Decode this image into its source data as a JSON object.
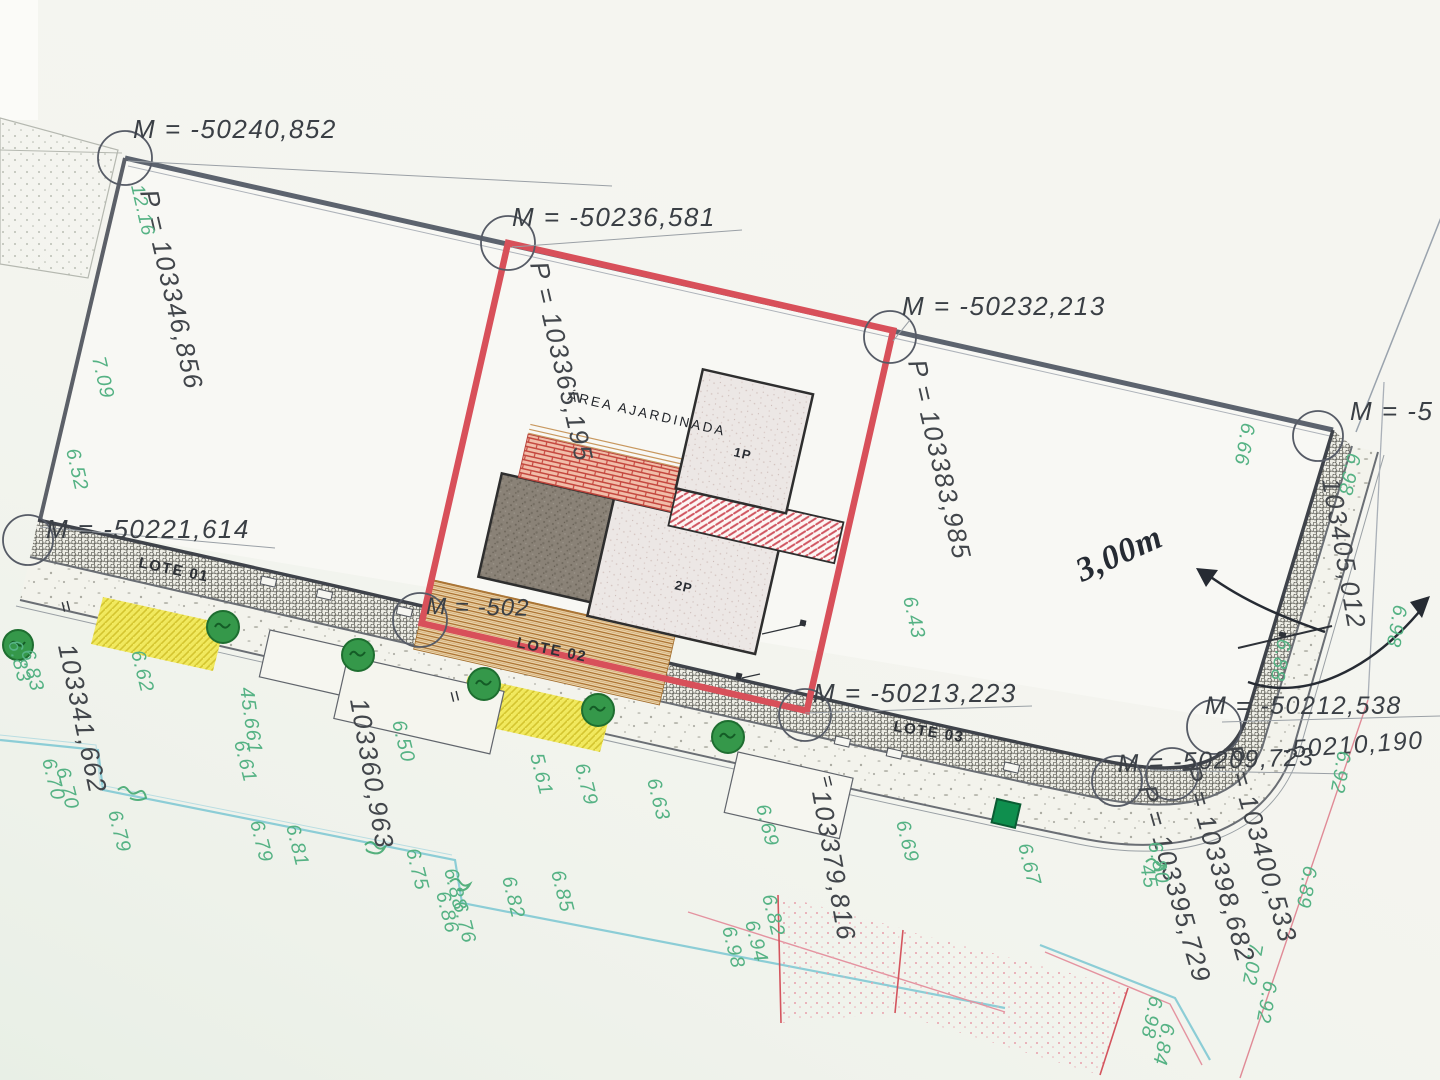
{
  "document": {
    "type": "survey site plan (planta de implantação)",
    "accent_red": "#d8505a",
    "green_note_color": "#55b284",
    "paper_color": "#f5f5f0"
  },
  "labels": {
    "m_points": [
      {
        "n": "m-coord-50240",
        "t": "M  =  -50240,852",
        "x": 133,
        "y": 138,
        "r": 0
      },
      {
        "n": "m-coord-50236",
        "t": "M  =  -50236,581",
        "x": 512,
        "y": 226,
        "r": 0
      },
      {
        "n": "m-coord-50232",
        "t": "M  =  -50232,213",
        "x": 902,
        "y": 315,
        "r": 0
      },
      {
        "n": "m-coord-edge-cut",
        "t": "M  =  -5",
        "x": 1350,
        "y": 420,
        "r": 0
      },
      {
        "n": "m-coord-50221",
        "t": "M  =  -50221,614",
        "x": 46,
        "y": 538,
        "r": 0
      },
      {
        "n": "m-coord-50213",
        "t": "M  =  -50213,223",
        "x": 813,
        "y": 702,
        "r": 0
      },
      {
        "n": "m-coord-50212",
        "t": "M  =  -50212,538",
        "x": 1205,
        "y": 714,
        "r": 0,
        "s": 25
      },
      {
        "n": "m-coord-50210",
        "t": "-50210,190",
        "x": 1283,
        "y": 758,
        "r": -4,
        "s": 25
      },
      {
        "n": "m-coord-50209",
        "t": "M  =  -50209,723",
        "x": 1118,
        "y": 772,
        "r": -2,
        "s": 25
      }
    ],
    "m_fragment": {
      "n": "m-coord-lote02-hidden",
      "t": "M  =  -502",
      "x": 426,
      "y": 614,
      "r": 1
    },
    "p_points": [
      {
        "n": "p-coord-103346",
        "t": "P  =  103346,856",
        "x": 140,
        "y": 192,
        "r": 77
      },
      {
        "n": "p-coord-103365",
        "t": "P  =  103365,195",
        "x": 530,
        "y": 264,
        "r": 77
      },
      {
        "n": "p-coord-103383",
        "t": "P  =  103383,985",
        "x": 908,
        "y": 362,
        "r": 77
      },
      {
        "n": "p-coord-103405",
        "t": "103405,012",
        "x": 1322,
        "y": 480,
        "r": 80
      },
      {
        "n": "p-coord-103400",
        "t": "P  =  103400,533",
        "x": 1224,
        "y": 748,
        "r": 74
      },
      {
        "n": "p-coord-103398",
        "t": "P  =  103398,682",
        "x": 1182,
        "y": 768,
        "r": 74
      },
      {
        "n": "p-coord-103395",
        "t": "P  =  103395,729",
        "x": 1138,
        "y": 788,
        "r": 74
      },
      {
        "n": "p-coord-103379",
        "t": "103379,816",
        "x": 812,
        "y": 792,
        "r": 80
      },
      {
        "n": "p-coord-103360",
        "t": "103360,963",
        "x": 350,
        "y": 700,
        "r": 80
      },
      {
        "n": "p-coord-103341",
        "t": "103341,662",
        "x": 58,
        "y": 646,
        "r": 78
      }
    ],
    "lotes": [
      {
        "n": "lote-01-label",
        "t": "LOTE 01",
        "x": 138,
        "y": 567,
        "r": 12
      },
      {
        "n": "lote-02-label",
        "t": "LOTE 02",
        "x": 516,
        "y": 647,
        "r": 12
      },
      {
        "n": "lote-03-label",
        "t": "LOTE 03",
        "x": 893,
        "y": 731,
        "r": 9
      }
    ],
    "area": {
      "text": "ÁREA AJARDINADA"
    },
    "buildings": [
      {
        "n": "building-1p-label",
        "t": "1P",
        "x": 733,
        "y": 456,
        "r": 13
      },
      {
        "n": "building-2p-label",
        "t": "2P",
        "x": 674,
        "y": 589,
        "r": 13
      }
    ],
    "handwritten": {
      "text": "3,00m"
    },
    "marks": [
      {
        "n": "level-mark",
        "t": "=",
        "x": 58,
        "y": 602,
        "r": 76
      },
      {
        "n": "level-mark",
        "t": "=",
        "x": 447,
        "y": 692,
        "r": 76
      },
      {
        "n": "level-mark",
        "t": "=",
        "x": 820,
        "y": 777,
        "r": 76
      }
    ]
  },
  "green_dims": [
    {
      "t": "12.16",
      "x": 131,
      "y": 186,
      "r": 77,
      "s": 19
    },
    {
      "t": "7.09",
      "x": 92,
      "y": 358,
      "r": 77
    },
    {
      "t": "6.52",
      "x": 66,
      "y": 450,
      "r": 77
    },
    {
      "t": "6.83",
      "x": 8,
      "y": 642,
      "r": 76
    },
    {
      "t": "6.83",
      "x": 21,
      "y": 651,
      "r": 76
    },
    {
      "t": "6.62",
      "x": 131,
      "y": 652,
      "r": 76
    },
    {
      "t": "6.70",
      "x": 42,
      "y": 760,
      "r": 76
    },
    {
      "t": "6.70",
      "x": 56,
      "y": 769,
      "r": 76
    },
    {
      "t": "45.661",
      "x": 240,
      "y": 688,
      "r": 82
    },
    {
      "t": "6.61",
      "x": 234,
      "y": 742,
      "r": 76
    },
    {
      "t": "6.79",
      "x": 108,
      "y": 812,
      "r": 76
    },
    {
      "t": "6.79",
      "x": 250,
      "y": 822,
      "r": 76
    },
    {
      "t": "6.81",
      "x": 286,
      "y": 826,
      "r": 76
    },
    {
      "t": "6.50",
      "x": 392,
      "y": 722,
      "r": 76
    },
    {
      "t": "5.61",
      "x": 530,
      "y": 755,
      "r": 76
    },
    {
      "t": "6.79",
      "x": 575,
      "y": 765,
      "r": 76
    },
    {
      "t": "6.63",
      "x": 647,
      "y": 780,
      "r": 76
    },
    {
      "t": "6.75",
      "x": 406,
      "y": 850,
      "r": 76
    },
    {
      "t": "6.88",
      "x": 444,
      "y": 870,
      "r": 76
    },
    {
      "t": "6.86",
      "x": 436,
      "y": 893,
      "r": 76
    },
    {
      "t": "6.82",
      "x": 502,
      "y": 878,
      "r": 76
    },
    {
      "t": "6.76",
      "x": 453,
      "y": 903,
      "r": 76
    },
    {
      "t": "6.85",
      "x": 551,
      "y": 872,
      "r": 76
    },
    {
      "t": "6.69",
      "x": 756,
      "y": 806,
      "r": 76
    },
    {
      "t": "6.82",
      "x": 762,
      "y": 896,
      "r": 76
    },
    {
      "t": "6.94",
      "x": 745,
      "y": 922,
      "r": 76
    },
    {
      "t": "6.98",
      "x": 722,
      "y": 928,
      "r": 76
    },
    {
      "t": "6.69",
      "x": 896,
      "y": 822,
      "r": 76
    },
    {
      "t": "6.67",
      "x": 1018,
      "y": 845,
      "r": 76
    },
    {
      "t": "6.80",
      "x": 1148,
      "y": 843,
      "r": 78
    },
    {
      "t": "45",
      "x": 1140,
      "y": 866,
      "r": 78
    },
    {
      "t": "6.66",
      "x": 1242,
      "y": 422,
      "r": 100
    },
    {
      "t": "6.98",
      "x": 1348,
      "y": 452,
      "r": 103
    },
    {
      "t": "6.98",
      "x": 1394,
      "y": 604,
      "r": 100
    },
    {
      "t": "6.88",
      "x": 1278,
      "y": 638,
      "r": 100
    },
    {
      "t": "6.92",
      "x": 1338,
      "y": 750,
      "r": 100
    },
    {
      "t": "6.89",
      "x": 1304,
      "y": 865,
      "r": 100
    },
    {
      "t": "7.02",
      "x": 1250,
      "y": 942,
      "r": 100
    },
    {
      "t": "6.92",
      "x": 1264,
      "y": 980,
      "r": 100
    },
    {
      "t": "6.98",
      "x": 1150,
      "y": 995,
      "r": 102
    },
    {
      "t": "6.84",
      "x": 1162,
      "y": 1022,
      "r": 102
    },
    {
      "t": "6.43",
      "x": 903,
      "y": 598,
      "r": 77
    }
  ]
}
